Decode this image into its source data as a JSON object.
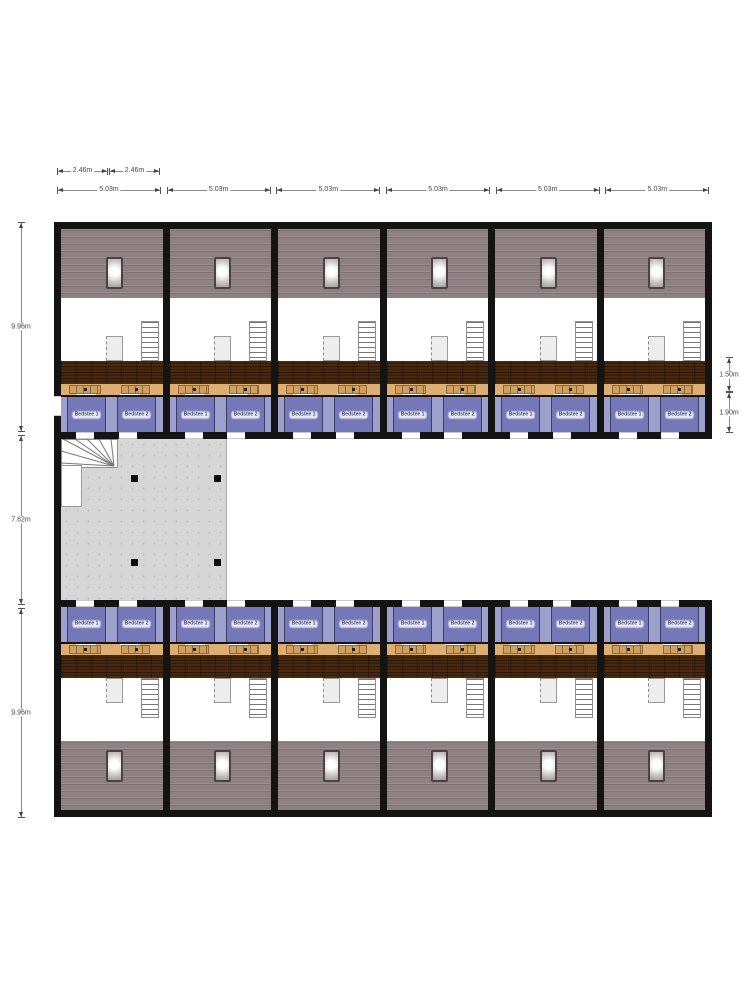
{
  "floor_plan": {
    "bed_labels": [
      "Bedstee 1",
      "Bedstee 2"
    ],
    "units_top": 6,
    "units_bottom": 6,
    "dimensions": {
      "top_row_small": [
        "2.46m",
        "2.46m"
      ],
      "top_row_units": [
        "5.03m",
        "5.03m",
        "5.03m",
        "5.03m",
        "5.03m",
        "5.03m"
      ],
      "left_column": [
        "9.96m",
        "7.62m",
        "9.96m"
      ],
      "right_column": [
        "1.50m",
        "1.90m"
      ]
    },
    "colors": {
      "wall": "#141414",
      "roof_deck": "#8e8083",
      "wood_floor": "#7d5e37",
      "step_band": "#dcae72",
      "bed_dark": "#7577b8",
      "bed_light": "#9da0cc",
      "landing_floor": "#d6d6d6"
    }
  }
}
